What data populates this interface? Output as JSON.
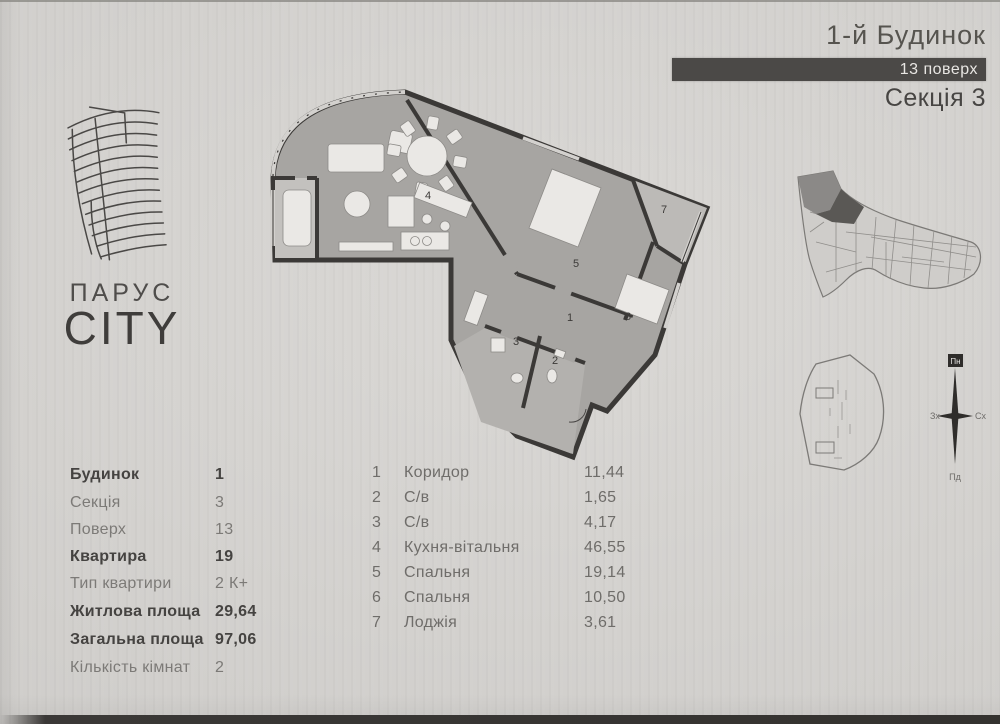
{
  "header": {
    "building": "1-й Будинок",
    "floor": "13 поверх",
    "section": "Секція 3"
  },
  "logo": {
    "name": "ПАРУС",
    "sub": "CITY"
  },
  "apartment_info": {
    "rows": [
      {
        "label": "Будинок",
        "value": "1"
      },
      {
        "label": "Секція",
        "value": "3"
      },
      {
        "label": "Поверх",
        "value": "13"
      },
      {
        "label": "Квартира",
        "value": "19"
      },
      {
        "label": "Тип квартири",
        "value": "2 К+"
      },
      {
        "label": "Житлова площа",
        "value": "29,64"
      },
      {
        "label": "Загальна площа",
        "value": "97,06"
      },
      {
        "label": "Кількість кімнат",
        "value": "2"
      }
    ]
  },
  "rooms": {
    "rows": [
      {
        "num": "1",
        "name": "Коридор",
        "area": "11,44"
      },
      {
        "num": "2",
        "name": "С/в",
        "area": "1,65"
      },
      {
        "num": "3",
        "name": "С/в",
        "area": "4,17"
      },
      {
        "num": "4",
        "name": "Кухня-вітальня",
        "area": "46,55"
      },
      {
        "num": "5",
        "name": "Спальня",
        "area": "19,14"
      },
      {
        "num": "6",
        "name": "Спальня",
        "area": "10,50"
      },
      {
        "num": "7",
        "name": "Лоджія",
        "area": "3,61"
      }
    ]
  },
  "compass": {
    "north": "Пн",
    "south": "Пд",
    "east": "Сх",
    "west": "Зх"
  },
  "colors": {
    "paper": "#d7d5d2",
    "wall": "#3b3937",
    "floor": "#a7a5a2",
    "furniture": "#eae8e5",
    "header_bar": "#4b4947"
  }
}
